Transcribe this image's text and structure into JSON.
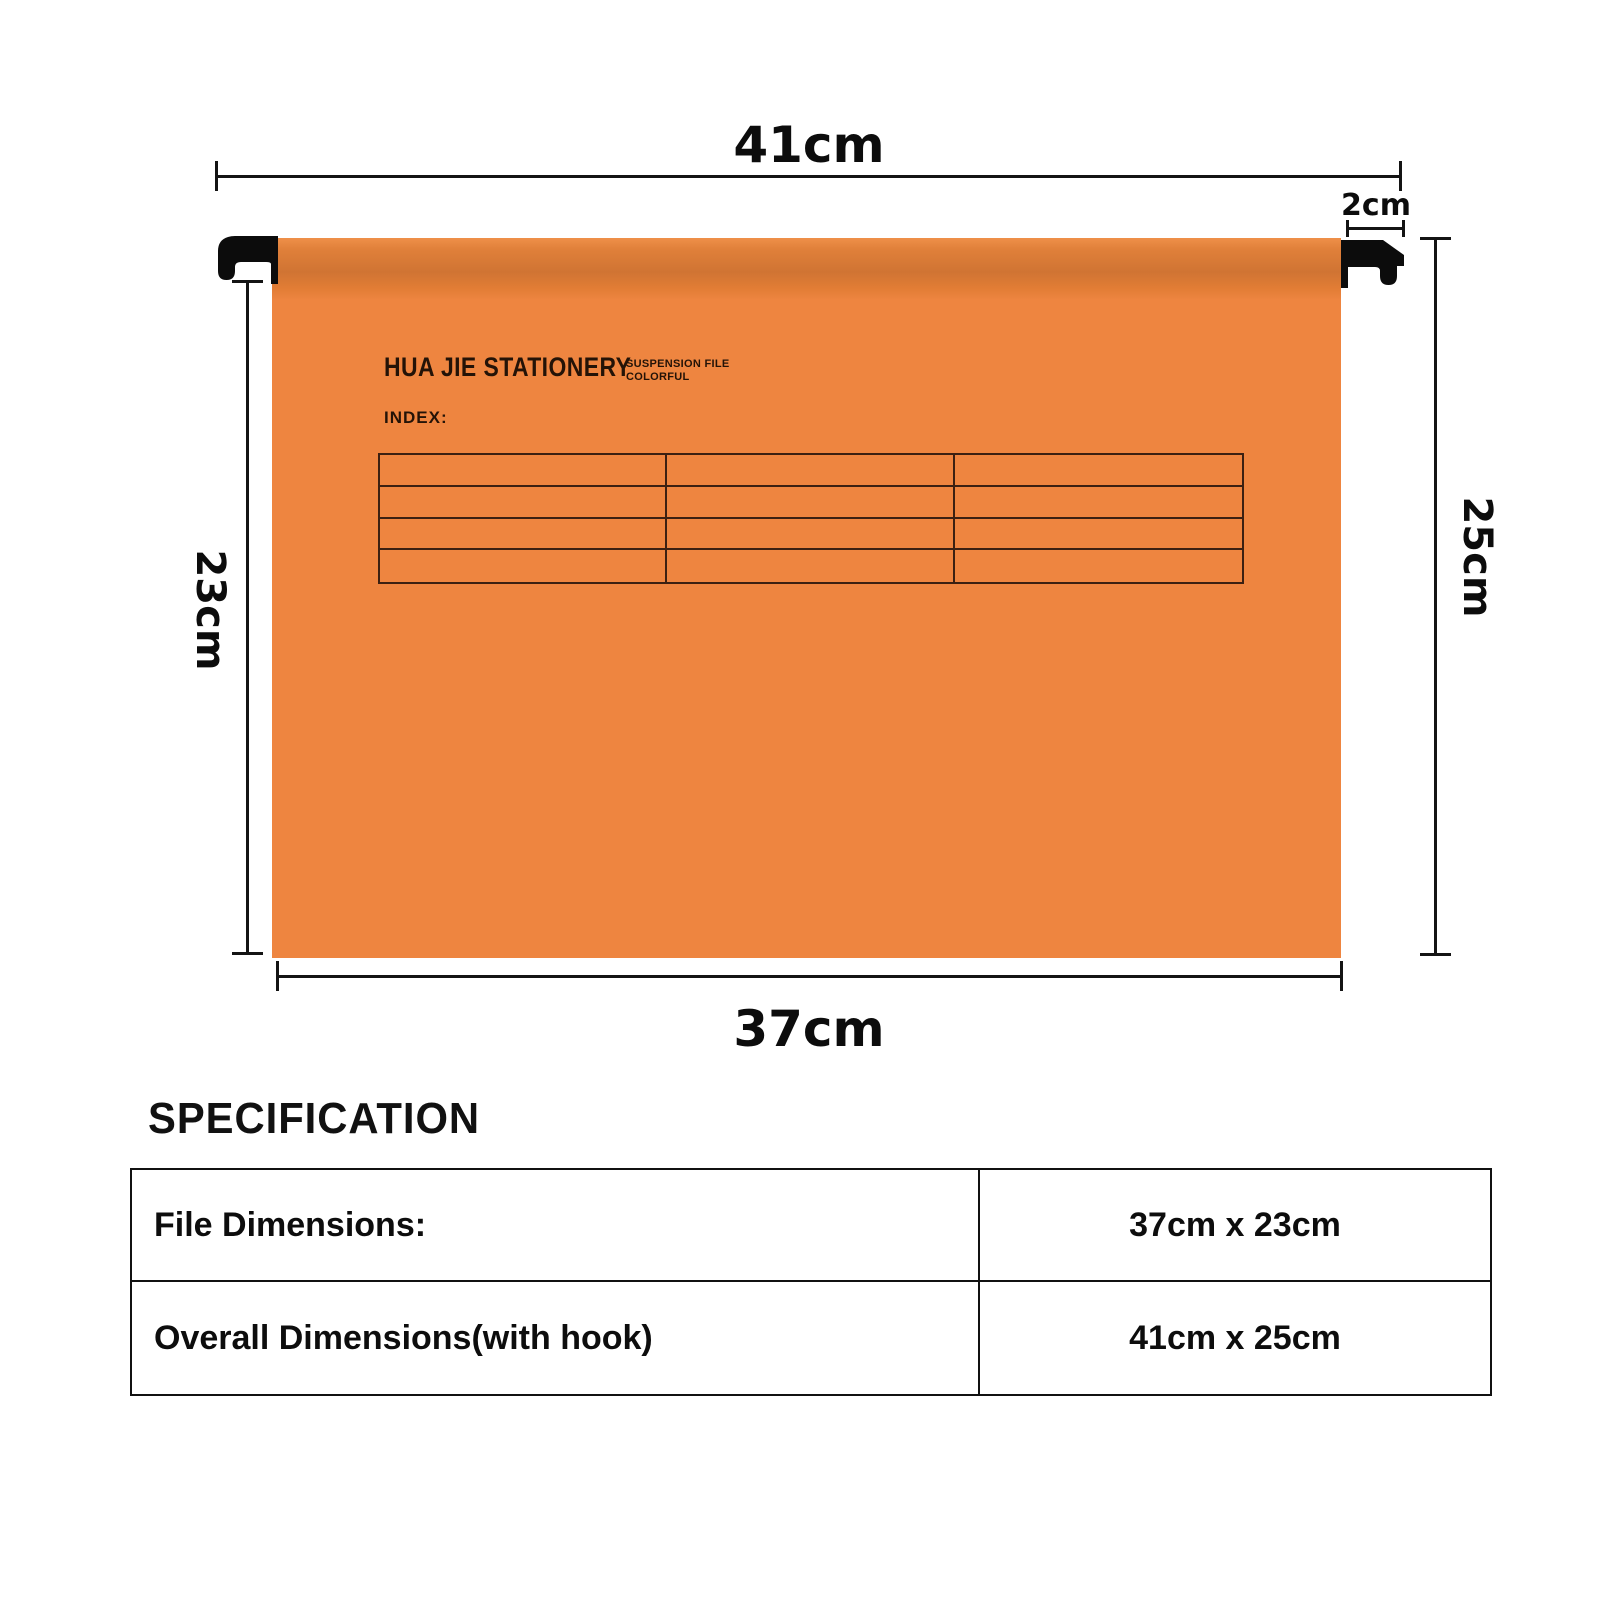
{
  "product_diagram": {
    "brand": "HUA JIE STATIONERY",
    "brand_sub_line1": "SUSPENSION FILE",
    "brand_sub_line2": "COLORFUL",
    "index_label": "INDEX:",
    "index_grid": {
      "rows": 4,
      "columns": 3
    },
    "dimensions": {
      "top_width": "41cm",
      "hook_width": "2cm",
      "left_height": "23cm",
      "right_height": "25cm",
      "bottom_width": "37cm"
    },
    "colors": {
      "folder_orange": "#ee8540",
      "folder_orange_dark": "#d07433",
      "grid_line": "#3b2012",
      "dimension_line": "#141414",
      "hook_black": "#0c0c0c"
    }
  },
  "specification": {
    "heading": "SPECIFICATION",
    "rows": [
      {
        "label": "File Dimensions:",
        "value": "37cm x 23cm"
      },
      {
        "label": "Overall Dimensions(with hook)",
        "value": "41cm x 25cm"
      }
    ]
  }
}
